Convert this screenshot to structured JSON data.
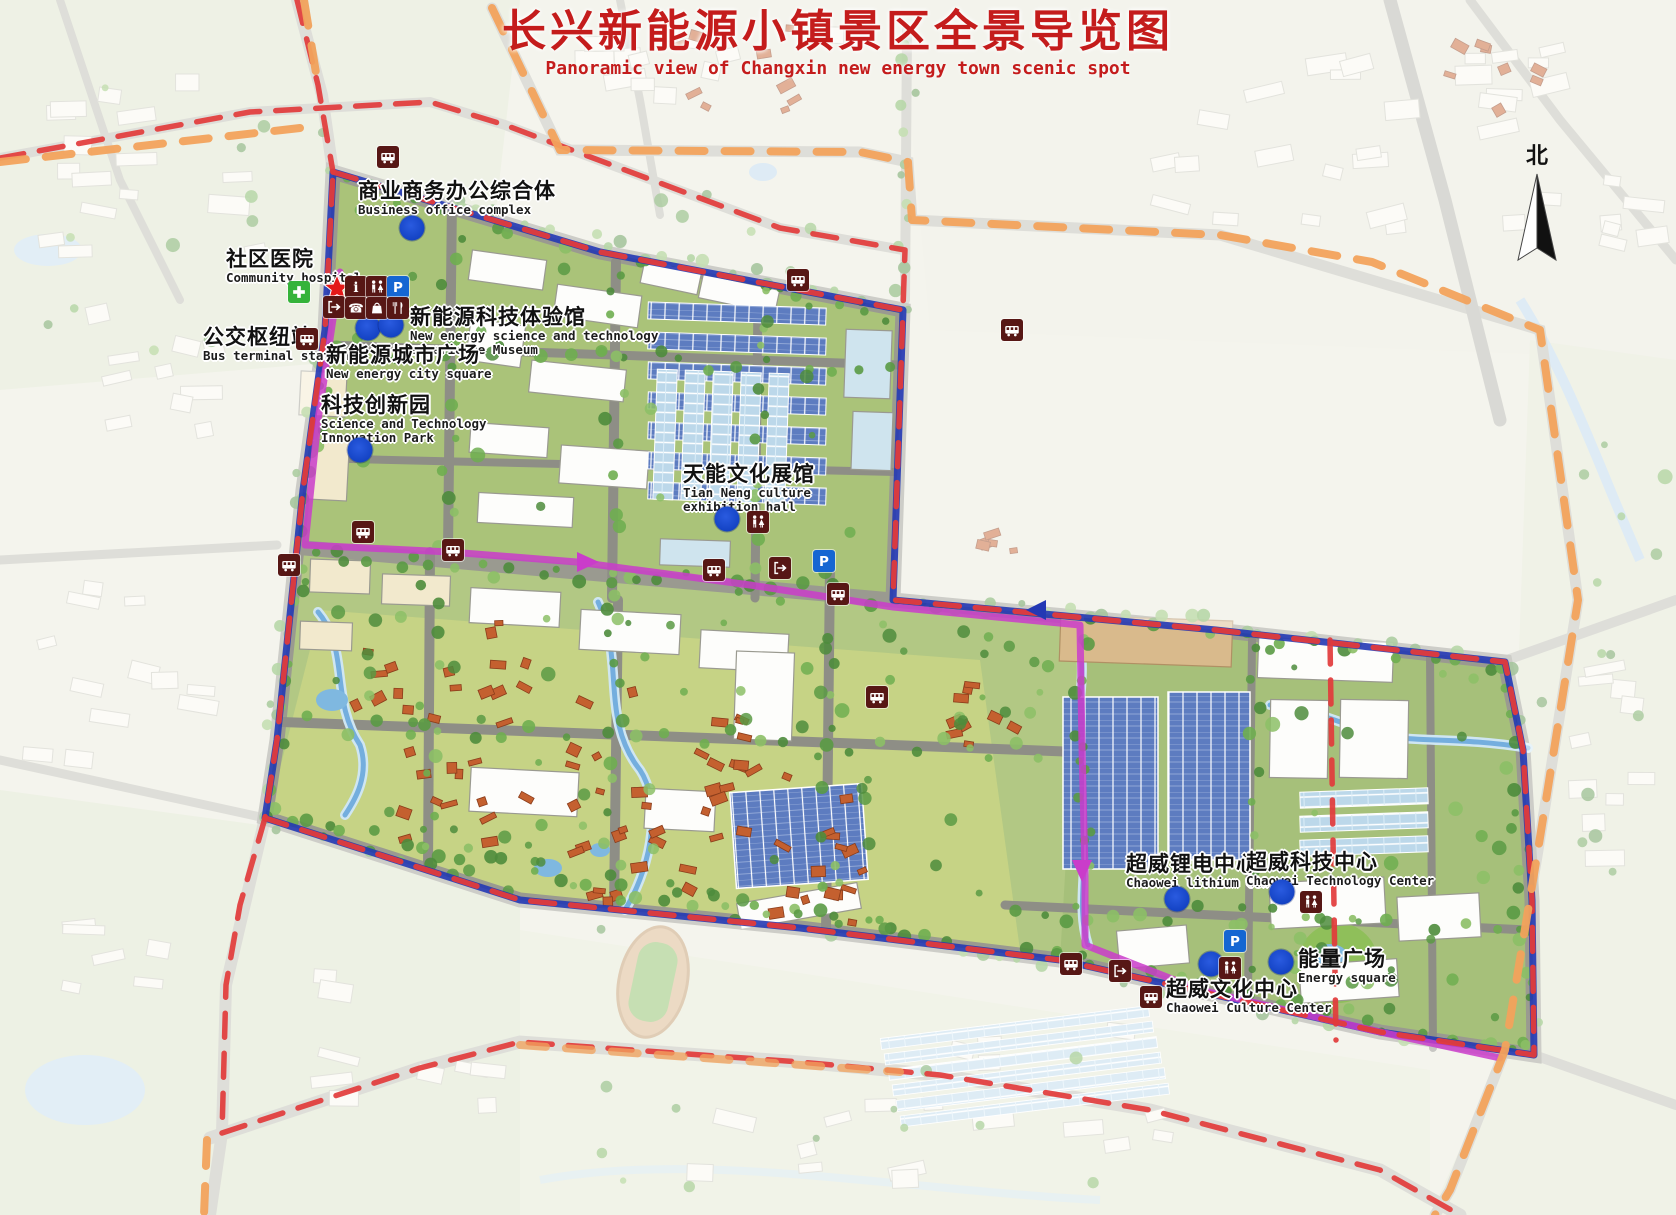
{
  "title": {
    "zh": "长兴新能源小镇景区全景导览图",
    "en": "Panoramic view of Changxin new energy town scenic spot"
  },
  "compass": {
    "label": "北"
  },
  "colors": {
    "title_red": "#c41c1c",
    "boundary_red": "#e23b3b",
    "boundary_blue": "#2338b4",
    "route_magenta": "#ca3cca",
    "boundary_orange": "#f2a25c",
    "poi_dot_blue": "#1443c4",
    "icon_maroon": "#571715",
    "parking_blue": "#1566d2",
    "hospital_green": "#35b33a",
    "star_red": "#e31919"
  },
  "pois": [
    {
      "id": "business-office-complex",
      "zh": "商业商务办公综合体",
      "en": "Business office complex",
      "x": 358,
      "y": 180
    },
    {
      "id": "community-hospital",
      "zh": "社区医院",
      "en": "Community hospital",
      "x": 226,
      "y": 248
    },
    {
      "id": "bus-terminal-station",
      "zh": "公交枢纽站",
      "en": "Bus terminal station",
      "x": 203,
      "y": 326
    },
    {
      "id": "new-energy-museum",
      "zh": "新能源科技体验馆",
      "en": "New energy science and technology\nexperience Museum",
      "x": 410,
      "y": 306
    },
    {
      "id": "new-energy-city-square",
      "zh": "新能源城市广场",
      "en": "New energy city square",
      "x": 326,
      "y": 344
    },
    {
      "id": "sci-tech-innovation-park",
      "zh": "科技创新园",
      "en": "Science and Technology\nInnovation Park",
      "x": 321,
      "y": 394
    },
    {
      "id": "tianneng-culture-hall",
      "zh": "天能文化展馆",
      "en": "Tian Neng culture\nexhibition hall",
      "x": 683,
      "y": 463
    },
    {
      "id": "chaowei-lithium-center",
      "zh": "超威锂电中心",
      "en": "Chaowei lithium Center",
      "x": 1126,
      "y": 853
    },
    {
      "id": "chaowei-technology-center",
      "zh": "超威科技中心",
      "en": "Chaowei Technology Center",
      "x": 1246,
      "y": 851
    },
    {
      "id": "energy-square",
      "zh": "能量广场",
      "en": "Energy square",
      "x": 1298,
      "y": 948
    },
    {
      "id": "chaowei-culture-center",
      "zh": "超威文化中心",
      "en": "Chaowei Culture Center",
      "x": 1166,
      "y": 978
    }
  ],
  "dots": [
    [
      412,
      228
    ],
    [
      368,
      328
    ],
    [
      391,
      325
    ],
    [
      360,
      450
    ],
    [
      727,
      519
    ],
    [
      1177,
      899
    ],
    [
      1282,
      892
    ],
    [
      1281,
      962
    ],
    [
      1211,
      964
    ]
  ],
  "icons": [
    {
      "type": "star",
      "x": 337,
      "y": 288
    },
    {
      "type": "info",
      "x": 356,
      "y": 287
    },
    {
      "type": "toilet",
      "x": 377,
      "y": 287
    },
    {
      "type": "parking",
      "x": 398,
      "y": 287
    },
    {
      "type": "exit",
      "x": 334,
      "y": 307
    },
    {
      "type": "phone",
      "x": 356,
      "y": 308
    },
    {
      "type": "shopping",
      "x": 377,
      "y": 308
    },
    {
      "type": "restaurant",
      "x": 398,
      "y": 308
    },
    {
      "type": "hospital-cross",
      "x": 299,
      "y": 292
    },
    {
      "type": "bus",
      "x": 307,
      "y": 339
    },
    {
      "type": "bus",
      "x": 388,
      "y": 157
    },
    {
      "type": "bus",
      "x": 798,
      "y": 280
    },
    {
      "type": "bus",
      "x": 1012,
      "y": 330
    },
    {
      "type": "bus",
      "x": 363,
      "y": 532
    },
    {
      "type": "bus",
      "x": 453,
      "y": 550
    },
    {
      "type": "bus",
      "x": 289,
      "y": 565
    },
    {
      "type": "bus",
      "x": 714,
      "y": 570
    },
    {
      "type": "bus",
      "x": 838,
      "y": 594
    },
    {
      "type": "bus",
      "x": 877,
      "y": 697
    },
    {
      "type": "bus",
      "x": 1071,
      "y": 964
    },
    {
      "type": "bus",
      "x": 1151,
      "y": 997
    },
    {
      "type": "exit",
      "x": 780,
      "y": 568
    },
    {
      "type": "exit",
      "x": 1120,
      "y": 971
    },
    {
      "type": "toilet",
      "x": 758,
      "y": 522
    },
    {
      "type": "toilet",
      "x": 1311,
      "y": 902
    },
    {
      "type": "toilet",
      "x": 1230,
      "y": 968
    },
    {
      "type": "parking",
      "x": 824,
      "y": 561
    },
    {
      "type": "parking",
      "x": 1235,
      "y": 941
    }
  ]
}
